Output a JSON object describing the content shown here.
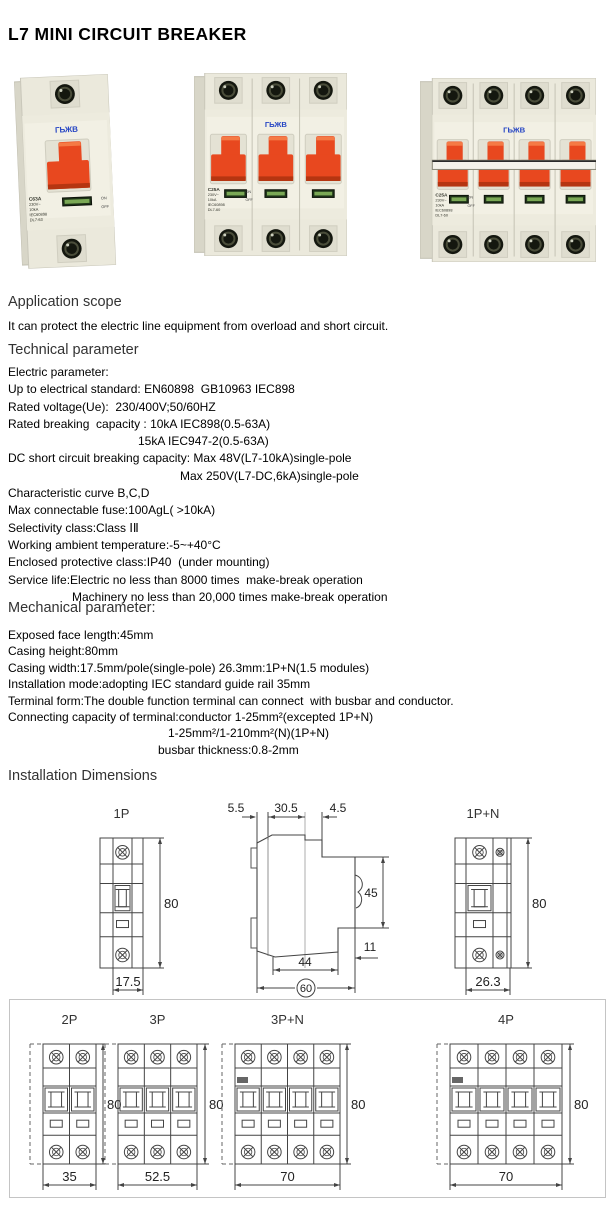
{
  "page_title": "L7 MINI CIRCUIT BREAKER",
  "colors": {
    "toggle_orange": "#e8481f",
    "toggle_shadow": "#b53511",
    "body_ivory": "#ebe9dc",
    "brand_blue": "#2746c4",
    "indicator_green_dark": "#1e3318",
    "indicator_green_light": "#7aa855"
  },
  "products": [
    {
      "id": "1p",
      "name": "single-pole breaker photo",
      "poles": 1,
      "brand": "ГЬЖВ",
      "label_lines": [
        "C63A",
        "230V~",
        "10kA",
        "IEC60898",
        "DL7-63"
      ],
      "switch_marks": [
        "ON",
        "OFF"
      ]
    },
    {
      "id": "3p",
      "name": "three-pole breaker photo",
      "poles": 3,
      "brand": "ГЬЖВ",
      "label_lines": [
        "C25A",
        "230V~",
        "10kA",
        "IEC60898",
        "DL7-60"
      ],
      "switch_marks": [
        "ON",
        "OFF"
      ]
    },
    {
      "id": "4p",
      "name": "four-pole breaker photo",
      "poles": 4,
      "brand": "ГЬЖВ",
      "label_lines": [
        "C25A",
        "230V~",
        "10kA",
        "IEC60898",
        "DL7-60"
      ],
      "switch_marks": [
        "ON",
        "OFF"
      ]
    }
  ],
  "sections": [
    {
      "id": "application",
      "heading": "Application scope",
      "lines": [
        {
          "text": "It can protect the electric line equipment from overload and short circuit."
        }
      ]
    },
    {
      "id": "technical",
      "heading": "Technical parameter",
      "lines": [
        {
          "text": "Electric parameter:"
        },
        {
          "text": "Up to electrical standard: EN60898  GB10963 IEC898"
        },
        {
          "text": "Rated voltage(Ue):  230/400V;50/60HZ"
        },
        {
          "text": "Rated breaking  capacity : 10kA IEC898(0.5-63A)"
        },
        {
          "text": "15kA IEC947-2(0.5-63A)",
          "indent": 130
        },
        {
          "text": "DC short circuit breaking capacity: Max 48V(L7-10kA)single-pole"
        },
        {
          "text": "Max 250V(L7-DC,6kA)single-pole",
          "indent": 172
        },
        {
          "text": "Characteristic curve B,C,D"
        },
        {
          "text": "Max connectable fuse:100AgL( >10kA)"
        },
        {
          "text": "Selectivity class:Class ⅠⅡ"
        },
        {
          "text": "Working ambient temperature:-5~+40°C"
        },
        {
          "text": "Enclosed protective class:IP40  (under mounting)"
        },
        {
          "text": "Service life:Electric no less than 8000 times  make-break operation"
        },
        {
          "text": "Machinery no less than 20,000 times make-break operation",
          "indent": 64
        }
      ]
    },
    {
      "id": "mechanical",
      "heading": "Mechanical parameter:",
      "lines": [
        {
          "text": "Exposed face length:45mm"
        },
        {
          "text": "Casing height:80mm"
        },
        {
          "text": "Casing width:17.5mm/pole(single-pole) 26.3mm:1P+N(1.5 modules)"
        },
        {
          "text": "Installation mode:adopting IEC standard guide rail 35mm"
        },
        {
          "text": "Terminal form:The double function terminal can connect  with busbar and conductor."
        },
        {
          "text": "Connecting capacity of terminal:conductor 1-25mm²(excepted 1P+N)"
        },
        {
          "text": "1-25mm²/1-210mm²(N)(1P+N)",
          "indent": 160
        },
        {
          "text": "busbar thickness:0.8-2mm",
          "indent": 150
        }
      ]
    },
    {
      "id": "installation",
      "heading": "Installation Dimensions",
      "lines": []
    }
  ],
  "installation": {
    "front_views": [
      {
        "id": "1p",
        "title": "1P",
        "height": "80",
        "width": "17.5"
      },
      {
        "id": "1pn",
        "title": "1P+N",
        "height": "80",
        "width": "26.3"
      },
      {
        "id": "2p",
        "title": "2P",
        "height": "80",
        "width": "35"
      },
      {
        "id": "3p",
        "title": "3P",
        "height": "80",
        "width": "52.5"
      },
      {
        "id": "3pn",
        "title": "3P+N",
        "height": "80",
        "width": "70"
      },
      {
        "id": "4p",
        "title": "4P",
        "height": "80",
        "width": "70"
      }
    ],
    "side_view": {
      "top_dims": [
        "5.5",
        "30.5",
        "4.5"
      ],
      "right_dims": [
        "45",
        "11"
      ],
      "bottom_dims": [
        "44",
        "60"
      ]
    }
  }
}
